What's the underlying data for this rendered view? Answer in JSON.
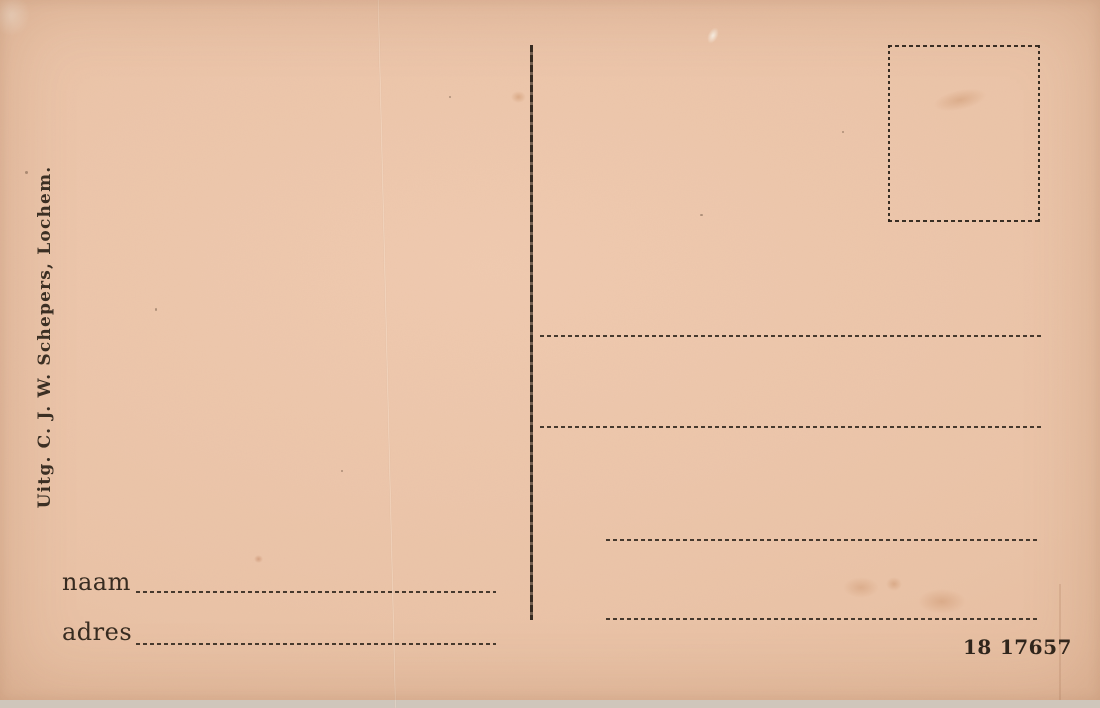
{
  "postcard": {
    "publisher_imprint": "Uitg. C. J. W. Schepers, Lochem.",
    "name_label": "naam",
    "address_label": "adres",
    "serial_prefix": "18",
    "serial_number": "17657",
    "colors": {
      "paper": "#eac3a7",
      "ink": "#33291f"
    }
  }
}
